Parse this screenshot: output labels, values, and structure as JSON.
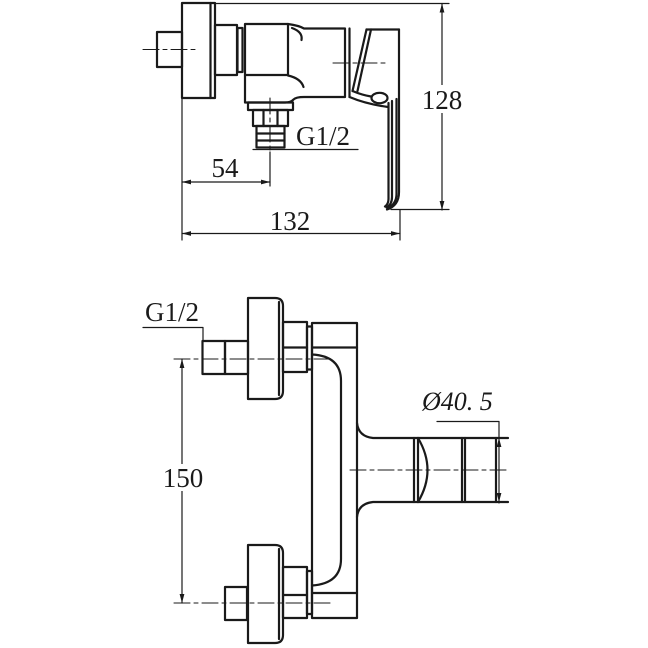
{
  "colors": {
    "line": "#1a1a1a",
    "background": "#ffffff"
  },
  "top_view": {
    "height_dim": "128",
    "outlet_offset_dim": "54",
    "width_dim": "132",
    "outlet_thread_label": "G1/2"
  },
  "front_view": {
    "inlet_spacing_dim": "150",
    "inlet_thread_label": "G1/2",
    "outlet_diameter_label": "Ø40. 5"
  }
}
